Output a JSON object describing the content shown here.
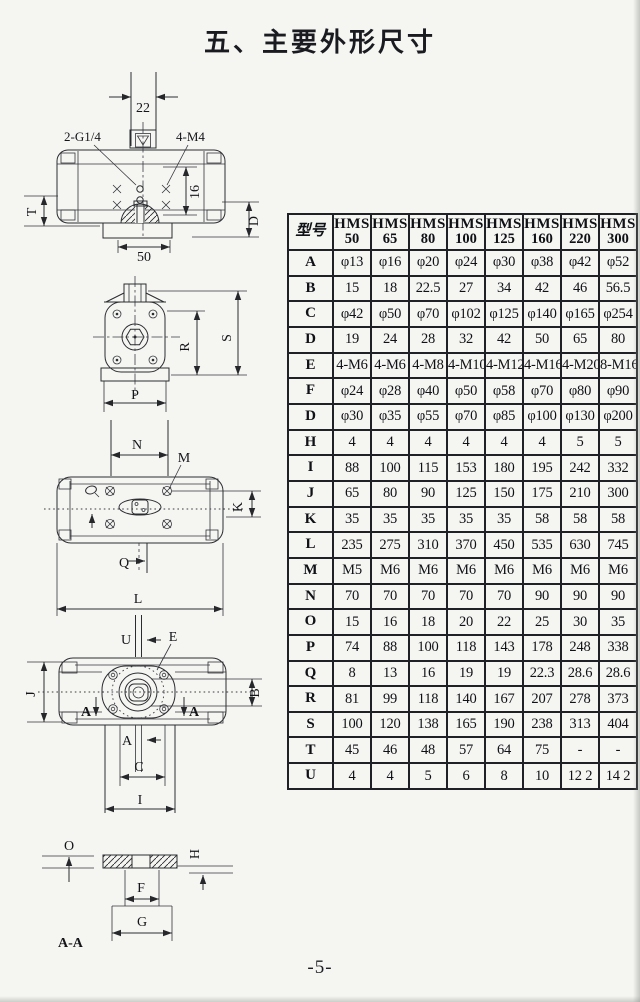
{
  "page": {
    "title": "五、主要外形尺寸",
    "page_number": "-5-"
  },
  "colors": {
    "paper": "#f5f6f2",
    "ink": "#2b2c30",
    "table_border": "#202126"
  },
  "table": {
    "model_header": "型号",
    "columns": [
      {
        "brand": "HMS",
        "size": "50"
      },
      {
        "brand": "HMS",
        "size": "65"
      },
      {
        "brand": "HMS",
        "size": "80"
      },
      {
        "brand": "HMS",
        "size": "100"
      },
      {
        "brand": "HMS",
        "size": "125"
      },
      {
        "brand": "HMS",
        "size": "160"
      },
      {
        "brand": "HMS",
        "size": "220"
      },
      {
        "brand": "HMS",
        "size": "300"
      }
    ],
    "rows": [
      {
        "label": "A",
        "values": [
          "φ13",
          "φ16",
          "φ20",
          "φ24",
          "φ30",
          "φ38",
          "φ42",
          "φ52"
        ]
      },
      {
        "label": "B",
        "values": [
          "15",
          "18",
          "22.5",
          "27",
          "34",
          "42",
          "46",
          "56.5"
        ]
      },
      {
        "label": "C",
        "values": [
          "φ42",
          "φ50",
          "φ70",
          "φ102",
          "φ125",
          "φ140",
          "φ165",
          "φ254"
        ]
      },
      {
        "label": "D",
        "values": [
          "19",
          "24",
          "28",
          "32",
          "42",
          "50",
          "65",
          "80"
        ]
      },
      {
        "label": "E",
        "values": [
          "4-M6",
          "4-M6",
          "4-M8",
          "4-M10",
          "4-M12",
          "4-M16",
          "4-M20",
          "8-M16"
        ]
      },
      {
        "label": "F",
        "values": [
          "φ24",
          "φ28",
          "φ40",
          "φ50",
          "φ58",
          "φ70",
          "φ80",
          "φ90"
        ]
      },
      {
        "label": "D",
        "values": [
          "φ30",
          "φ35",
          "φ55",
          "φ70",
          "φ85",
          "φ100",
          "φ130",
          "φ200"
        ]
      },
      {
        "label": "H",
        "values": [
          "4",
          "4",
          "4",
          "4",
          "4",
          "4",
          "5",
          "5"
        ]
      },
      {
        "label": "I",
        "values": [
          "88",
          "100",
          "115",
          "153",
          "180",
          "195",
          "242",
          "332"
        ]
      },
      {
        "label": "J",
        "values": [
          "65",
          "80",
          "90",
          "125",
          "150",
          "175",
          "210",
          "300"
        ]
      },
      {
        "label": "K",
        "values": [
          "35",
          "35",
          "35",
          "35",
          "35",
          "58",
          "58",
          "58"
        ]
      },
      {
        "label": "L",
        "values": [
          "235",
          "275",
          "310",
          "370",
          "450",
          "535",
          "630",
          "745"
        ]
      },
      {
        "label": "M",
        "values": [
          "M5",
          "M6",
          "M6",
          "M6",
          "M6",
          "M6",
          "M6",
          "M6"
        ]
      },
      {
        "label": "N",
        "values": [
          "70",
          "70",
          "70",
          "70",
          "70",
          "90",
          "90",
          "90"
        ]
      },
      {
        "label": "O",
        "values": [
          "15",
          "16",
          "18",
          "20",
          "22",
          "25",
          "30",
          "35"
        ]
      },
      {
        "label": "P",
        "values": [
          "74",
          "88",
          "100",
          "118",
          "143",
          "178",
          "248",
          "338"
        ]
      },
      {
        "label": "Q",
        "values": [
          "8",
          "13",
          "16",
          "19",
          "19",
          "22.3",
          "28.6",
          "28.6"
        ]
      },
      {
        "label": "R",
        "values": [
          "81",
          "99",
          "118",
          "140",
          "167",
          "207",
          "278",
          "373"
        ]
      },
      {
        "label": "S",
        "values": [
          "100",
          "120",
          "138",
          "165",
          "190",
          "238",
          "313",
          "404"
        ]
      },
      {
        "label": "T",
        "values": [
          "45",
          "46",
          "48",
          "57",
          "64",
          "75",
          "-",
          "-"
        ]
      },
      {
        "label": "U",
        "values": [
          "4",
          "4",
          "5",
          "6",
          "8",
          "10",
          "12 2",
          "14 2"
        ]
      }
    ]
  },
  "drawings": {
    "front_view": {
      "labels": {
        "d22": "22",
        "port": "2-G1/4",
        "bolts": "4-M4",
        "d16": "16",
        "t": "T",
        "d": "D",
        "d50": "50"
      }
    },
    "end_view": {
      "labels": {
        "r": "R",
        "s": "S",
        "p": "P"
      }
    },
    "top_view": {
      "labels": {
        "n": "N",
        "m": "M",
        "k": "K",
        "q": "Q",
        "l": "L"
      }
    },
    "bottom_view": {
      "labels": {
        "u": "U",
        "e": "E",
        "j": "J",
        "b": "B",
        "a_left": "A",
        "a_right": "A",
        "a": "A",
        "c": "C",
        "i": "I"
      }
    },
    "section_view": {
      "labels": {
        "o": "O",
        "h": "H",
        "f": "F",
        "g": "G",
        "caption": "A-A"
      }
    }
  }
}
